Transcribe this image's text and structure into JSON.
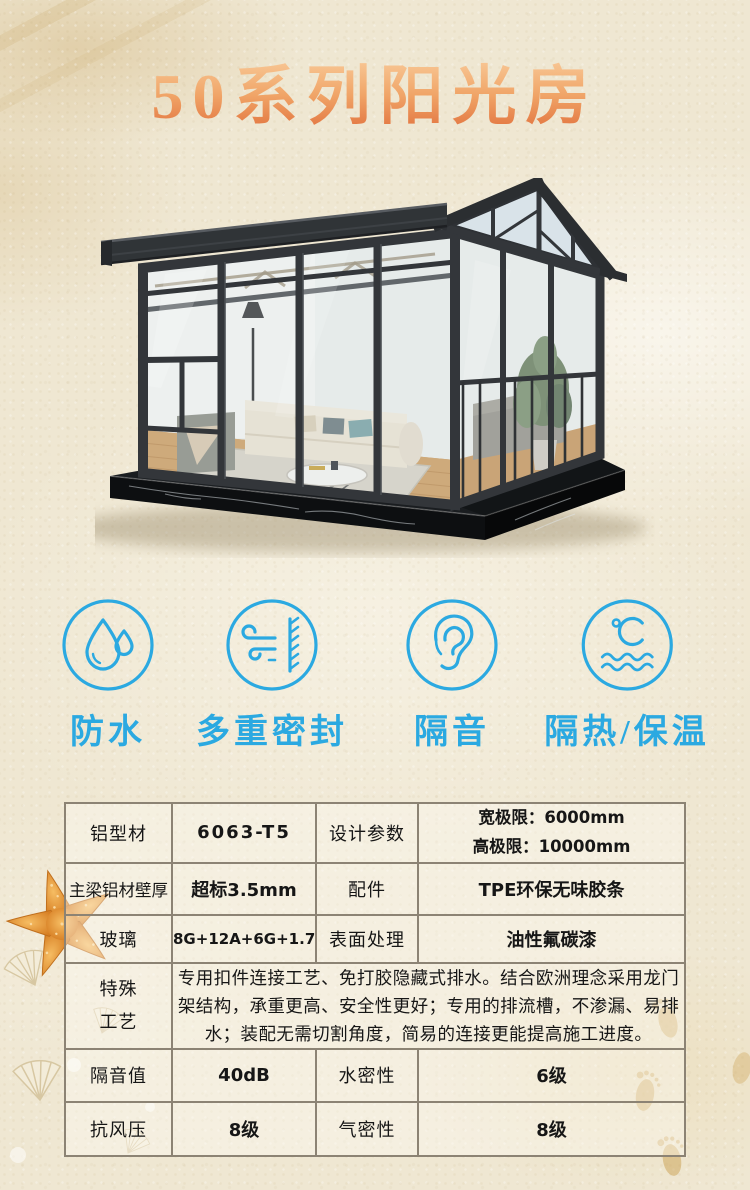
{
  "title": "50系列阳光房",
  "features": [
    {
      "label": "防水",
      "icon": "water-drop-icon"
    },
    {
      "label": "多重密封",
      "icon": "wind-seal-icon"
    },
    {
      "label": "隔音",
      "icon": "ear-icon"
    },
    {
      "label": "隔热/保温",
      "icon": "temperature-icon"
    }
  ],
  "spec_table": {
    "rows": [
      [
        "铝型材",
        "6063-T5",
        "设计参数",
        "宽极限：6000mm\n高极限：10000mm"
      ],
      [
        "主梁铝材壁厚",
        "超标3.5mm",
        "配件",
        "TPE环保无味胶条"
      ],
      [
        "玻璃",
        "8G+12A+6G+1.76PVB+6G",
        "表面处理",
        "油性氟碳漆"
      ],
      [
        "特殊\n工艺",
        "专用扣件连接工艺、免打胶隐藏式排水。结合欧洲理念采用龙门架结构，承重更高、安全性更好；专用的排流槽，不渗漏、易排水；装配无需切割角度，简易的连接更能提高施工进度。"
      ],
      [
        "隔音值",
        "40dB",
        "水密性",
        "6级"
      ],
      [
        "抗风压",
        "8级",
        "气密性",
        "8级"
      ]
    ]
  },
  "colors": {
    "accent_blue": "#2BA9E1",
    "title_gradient_top": "#F8C795",
    "title_gradient_bottom": "#E1703C",
    "table_border": "#8C8374",
    "sand_base": "#EFE7D2",
    "frame_dark": "#33363A"
  }
}
